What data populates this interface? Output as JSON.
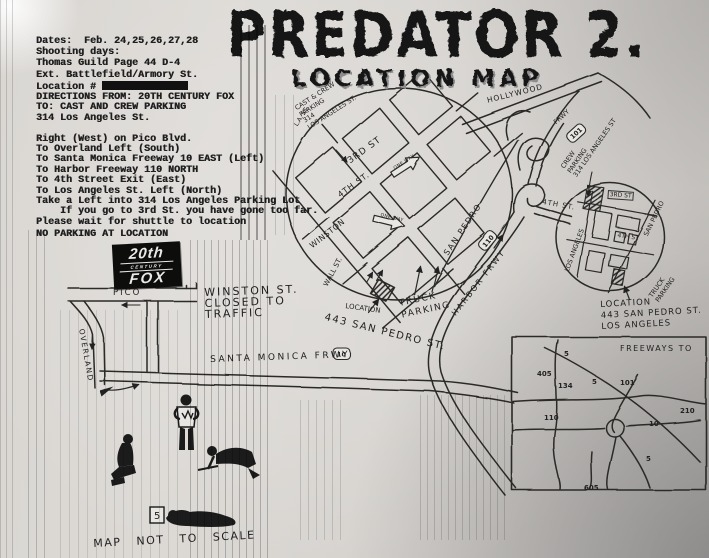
{
  "header": {
    "line1": "Dates:  Feb. 24,25,26,27,28",
    "line2": "Shooting days:",
    "line3": "Thomas Guild Page 44 D-4",
    "line4": "Ext. Battlefield/Armory St.",
    "location_label": "Location #"
  },
  "title": {
    "main": "PREDATOR 2.",
    "sub": "LOCATION MAP"
  },
  "directions": {
    "lines": [
      "DIRECTIONS FROM: 20TH CENTURY FOX",
      "TO: CAST AND CREW PARKING",
      "314 Los Angeles St.",
      "",
      "Right (West) on Pico Blvd.",
      "To Overland Left (South)",
      "To Santa Monica Freeway 10 EAST (Left)",
      "To Harbor Freeway 110 NORTH",
      "To 4th Street Exit (East)",
      "To Los Angeles St. Left (North)",
      "Take a Left into 314 Los Angeles Parking Lot",
      "    If you go to 3rd St. you have gone too far.",
      "Please wait for shuttle to location"
    ],
    "no_parking": "NO PARKING AT LOCATION"
  },
  "fox_logo": {
    "top": "20th",
    "mid": "CENTURY",
    "bottom": "FOX"
  },
  "map": {
    "cast_crew_note": {
      "l1": "CAST & CREW",
      "l2": "PARKING",
      "l3": "314",
      "l4": "LOS ANGELES ST."
    },
    "street_3rd": "3RD ST",
    "street_4th": "4TH ST.",
    "street_winston": "WINSTON",
    "street_wall": "WALL ST.",
    "street_la": "L.A. ST.",
    "street_san_pedro": "SAN PEDRO",
    "one_way": "ONE WAY",
    "harbor_frwy": "HARBOR FRWY",
    "shield_110": "110",
    "hollywood": "HOLLYWOOD",
    "frwy": "FRWY",
    "shield_101": "101",
    "santa_monica_frwy": "SANTA MONICA FRWY",
    "shield_10": "10",
    "pico": "PICO",
    "overland": "OVERLAND",
    "exit_4th": "4TH ST.",
    "crew_note": {
      "l1": "CREW",
      "l2": "PARKING",
      "l3": "314 LOS ANGELES ST"
    },
    "right_circle": {
      "street_3rd": "3RD ST",
      "street_4th": "4TH ST",
      "san_pedro": "SAN PEDRO",
      "los_angeles": "LOS ANGELES",
      "truck1": "TRUCK",
      "truck2": "PARKING"
    },
    "location_right": {
      "l1": "LOCATION",
      "l2": "443 SAN PEDRO ST.",
      "l3": "LOS ANGELES"
    },
    "location_center": {
      "l1": "LOCATION",
      "l2": "443 SAN PEDRO ST."
    },
    "truck_center": {
      "l1": "TRUCK",
      "l2": "PARKING"
    },
    "winston_closed": {
      "l1": "WINSTON ST.",
      "l2": "CLOSED TO",
      "l3": "TRAFFIC"
    },
    "scale_note": "MAP NOT TO SCALE",
    "sign": "5"
  },
  "inset": {
    "title": "FREEWAYS TO",
    "freeways": [
      {
        "n": "405"
      },
      {
        "n": "5"
      },
      {
        "n": "134"
      },
      {
        "n": "5"
      },
      {
        "n": "101"
      },
      {
        "n": "210"
      },
      {
        "n": "110"
      },
      {
        "n": "10"
      },
      {
        "n": "5"
      },
      {
        "n": "605"
      }
    ]
  }
}
